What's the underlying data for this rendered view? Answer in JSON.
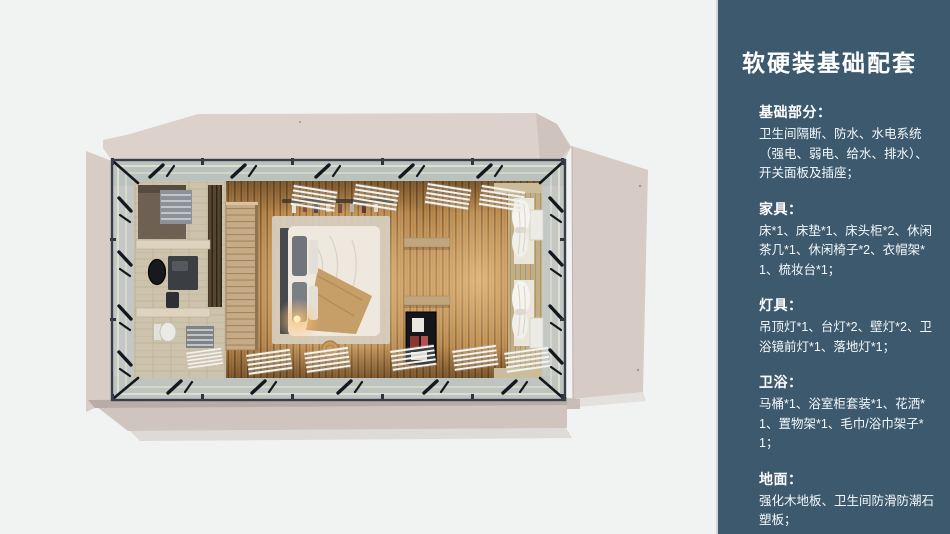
{
  "page": {
    "background_color": "#f1f2f2"
  },
  "panel": {
    "background_color": "#3c596d",
    "text_color": "#ffffff",
    "title": "软硬装基础配套",
    "sections": [
      {
        "heading": "基础部分：",
        "body": "卫生间隔断、防水、水电系统（强电、弱电、给水、排水）、开关面板及插座；"
      },
      {
        "heading": "家具：",
        "body": "床*1、床垫*1、床头柜*2、休闲茶几*1、休闲椅子*2、衣帽架*1、梳妆台*1；"
      },
      {
        "heading": "灯具：",
        "body": "吊顶灯*1、台灯*2、壁灯*2、卫浴镜前灯*1、落地灯*1；"
      },
      {
        "heading": "卫浴：",
        "body": "马桶*1、浴室柜套装*1、花洒*1、置物架*1、毛巾/浴巾架子*1；"
      },
      {
        "heading": "地面：",
        "body": "强化木地板、卫生间防滑防潮石塑板；"
      }
    ]
  },
  "floorplan": {
    "view": "top-down cabin render",
    "accent_colors": {
      "wood_floor": "#b8874b",
      "flap_beige": "#d9cfc8",
      "frame_dark": "#383f4b",
      "glow_warm": "#ffd79e"
    }
  }
}
